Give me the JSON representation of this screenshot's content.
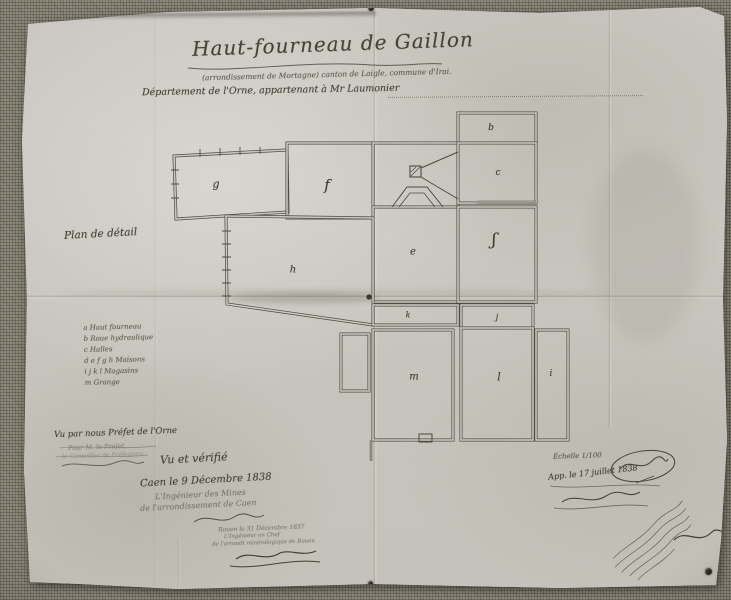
{
  "photo": {
    "paper_color": "#c9c7c0",
    "canvas_color": "#8b8779",
    "ink_color": "#474338"
  },
  "header": {
    "title": "Haut-fourneau de Gaillon",
    "subtitle": "(arrondissement de Mortagne) canton de Laigle, commune d'Irai.",
    "department_line": "Département de l'Orne, appartenant à Mr Laumonier"
  },
  "labels": {
    "plan_label": "Plan de détail"
  },
  "legend": {
    "lines": [
      "a  Haut fourneau",
      "b  Roue hydraulique",
      "c  Halles",
      "d e f g h  Maisons",
      "i j k l  Magasins",
      "m  Grange"
    ]
  },
  "plan": {
    "rooms": [
      {
        "label": "g"
      },
      {
        "label": "f"
      },
      {
        "label": "b"
      },
      {
        "label": "c"
      },
      {
        "label": "e"
      },
      {
        "label": "ʃ"
      },
      {
        "label": "h"
      },
      {
        "label": "k"
      },
      {
        "label": "j"
      },
      {
        "label": "m"
      },
      {
        "label": "l"
      },
      {
        "label": "i"
      }
    ]
  },
  "annotations": {
    "prefect": {
      "line1": "Vu par nous Préfet de l'Orne",
      "line2": "Pour M. le Préfet,",
      "line3": "le Conseiller de Préfecture"
    },
    "verification": {
      "line1": "Vu et vérifié",
      "line2": "Caen le 9 Décembre 1838",
      "line3": "L'Ingénieur des Mines",
      "line4": "de l'arrondissement de Caen"
    },
    "chief_engineer": {
      "line1": "Rouen le 31 Décembre 1837",
      "line2": "L'Ingénieur en Chef",
      "line3": "de l'arrondt minéralogique de Rouen"
    },
    "approval": {
      "scale": "Échelle 1/100",
      "line1": "App. le 17 juillet 1838"
    }
  }
}
